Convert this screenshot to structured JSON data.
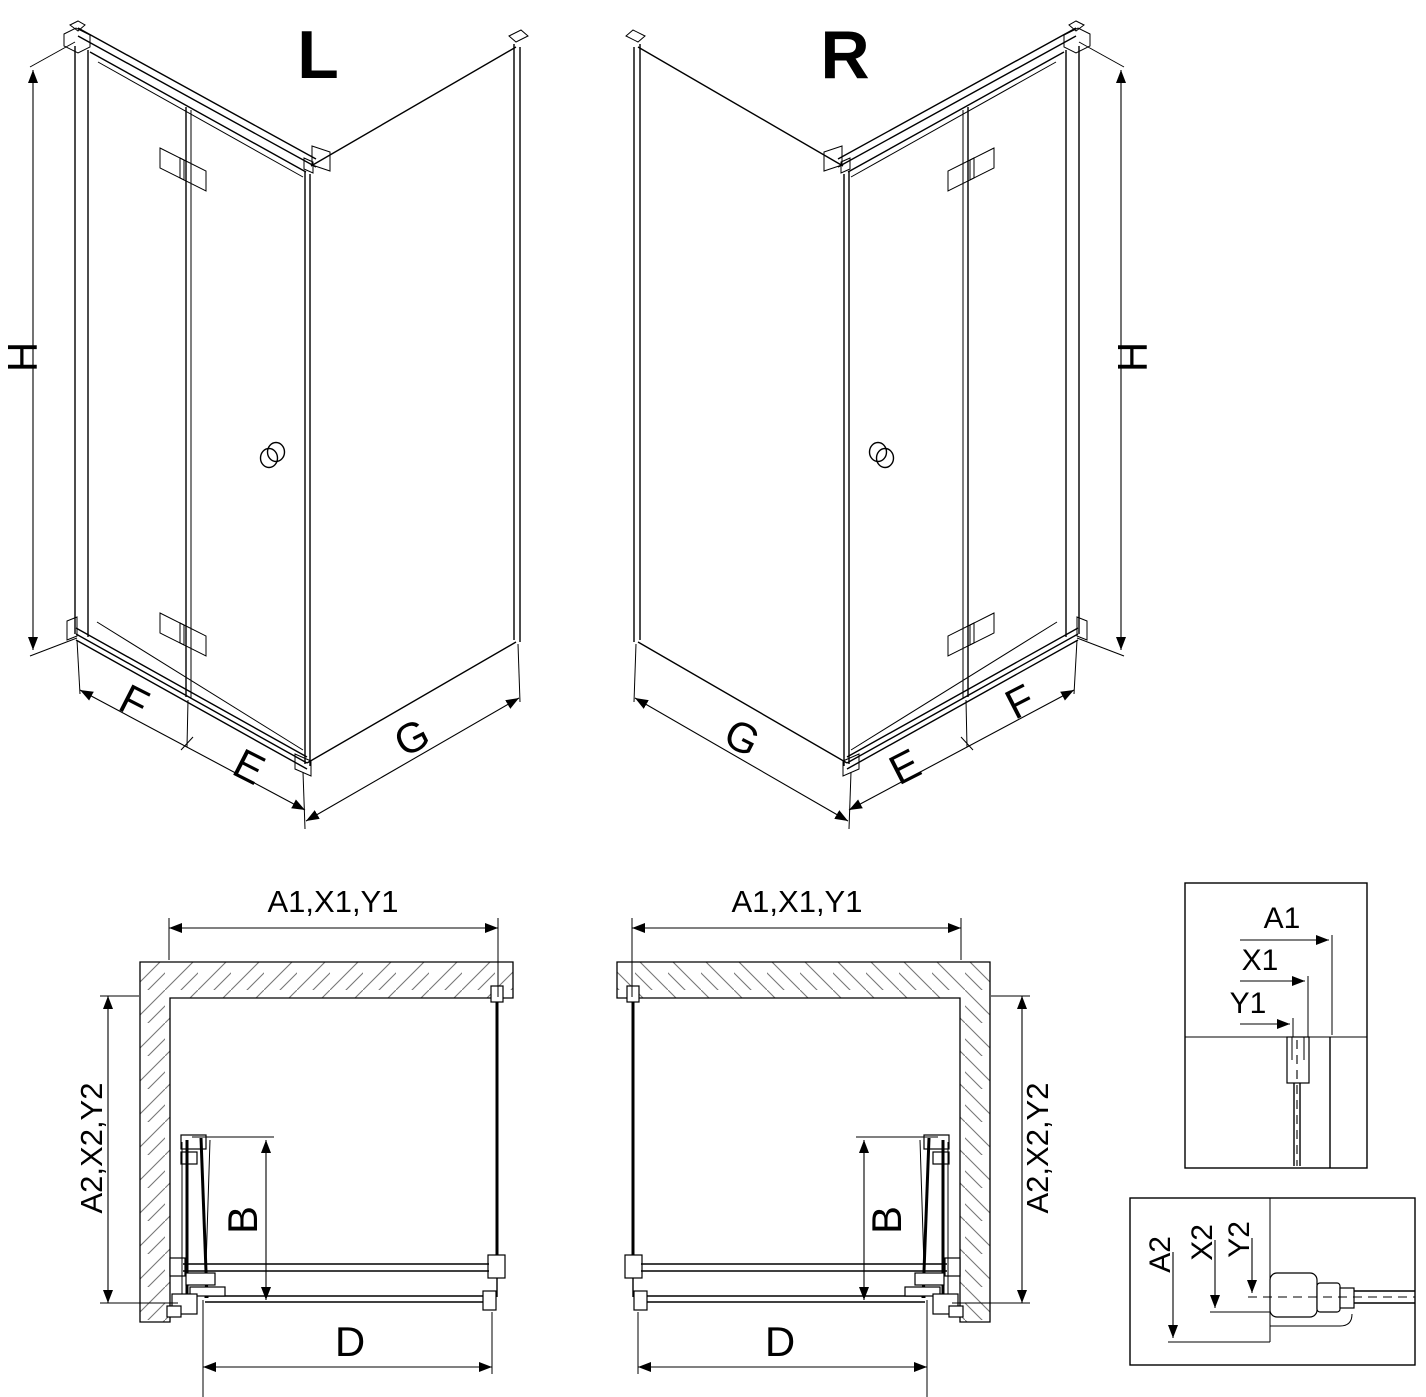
{
  "drawing": {
    "variant_left": {
      "label": "L",
      "height": "H",
      "door_panel": "F",
      "fixed_panel": "E",
      "side_panel": "G"
    },
    "variant_right": {
      "label": "R",
      "height": "H",
      "door_panel": "F",
      "fixed_panel": "E",
      "side_panel": "G"
    },
    "plan_left": {
      "width": "A1,X1,Y1",
      "depth": "A2,X2,Y2",
      "door_projection": "B",
      "entry": "D"
    },
    "plan_right": {
      "width": "A1,X1,Y1",
      "depth": "A2,X2,Y2",
      "door_projection": "B",
      "entry": "D"
    },
    "detail_width": {
      "wall": "A1",
      "profile": "X1",
      "glass": "Y1"
    },
    "detail_depth": {
      "wall": "A2",
      "profile": "X2",
      "glass": "Y2"
    }
  },
  "colors": {
    "line": "#000000",
    "hatch": "#777777",
    "background": "#ffffff"
  }
}
